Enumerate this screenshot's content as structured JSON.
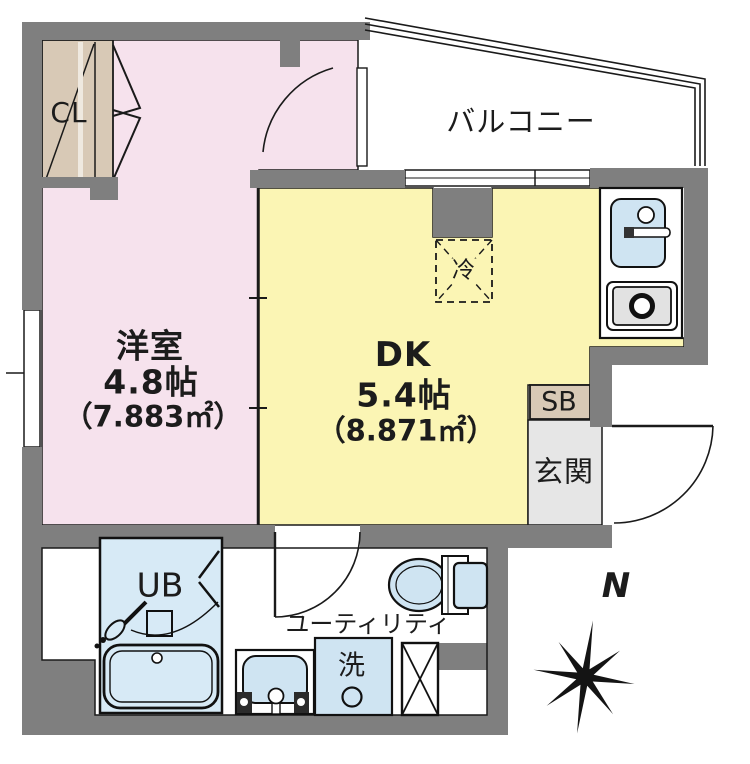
{
  "rooms": {
    "western": {
      "name": "洋室",
      "size": "4.8帖",
      "area": "（7.883㎡）"
    },
    "dk": {
      "name": "DK",
      "size": "5.4帖",
      "area": "（8.871㎡）"
    },
    "balcony": {
      "name": "バルコニー"
    },
    "entrance": {
      "name": "玄関"
    },
    "utility": {
      "name": "ユーティリティ"
    },
    "unit_bath": {
      "label": "UB"
    },
    "closet": {
      "label": "CL"
    },
    "shoe_box": {
      "label": "SB"
    }
  },
  "fixtures": {
    "refrigerator": {
      "label": "冷"
    },
    "washer": {
      "label": "洗"
    }
  },
  "compass": {
    "north_label": "N"
  },
  "colors": {
    "wall": "#7f7f7f",
    "western_room": "#f6e2ed",
    "dk_room": "#fbf5b4",
    "closet": "#d8c9b6",
    "fixture_blue": "#cfe4f2",
    "bath_blue": "#d7eaf6",
    "entrance_floor": "#e6e6e6",
    "line": "#1a1a1a"
  }
}
